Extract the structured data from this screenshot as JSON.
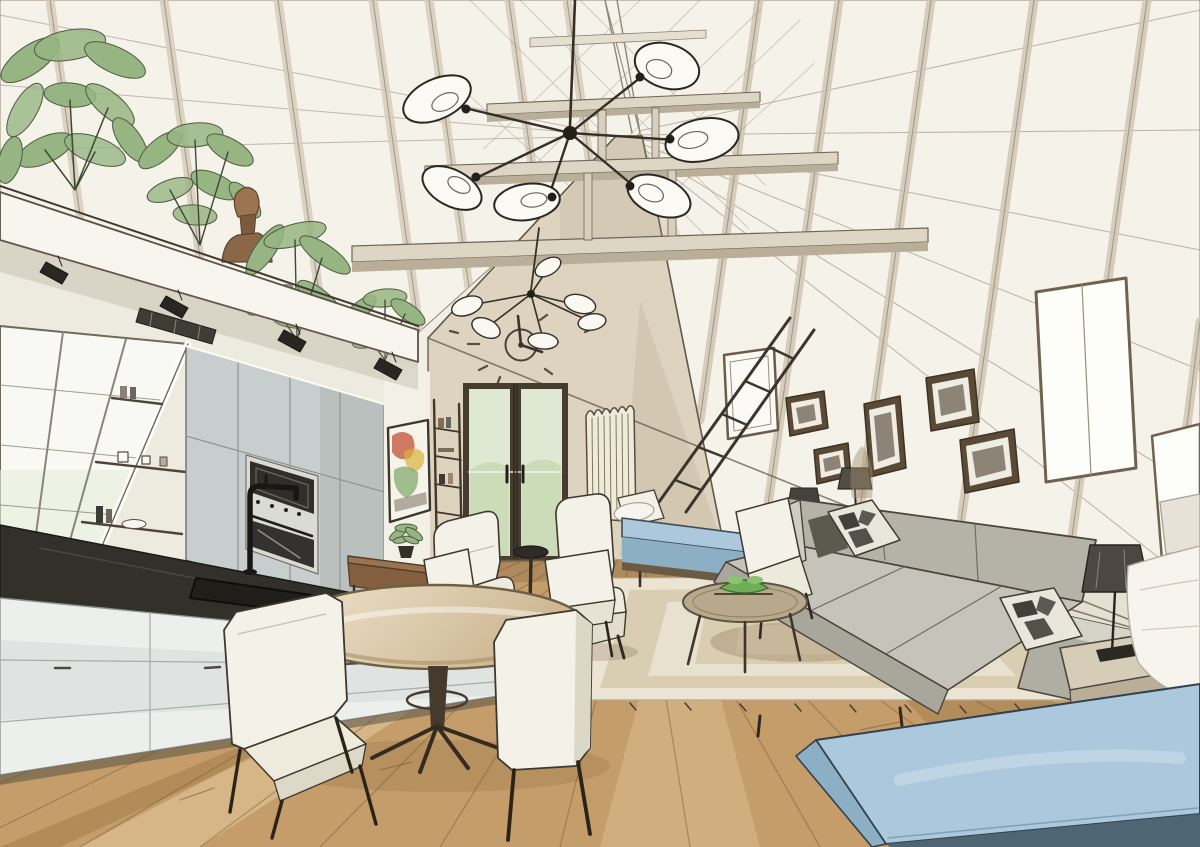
{
  "artwork": {
    "type": "ink-and-watercolor-interior-sketch",
    "subject": "A-frame attic loft living space with kitchen, dining and lounge areas",
    "objects": [
      "vaulted plank ceiling with exposed tie beams",
      "large sputnik chandelier with six glass bulbs",
      "small sputnik chandelier",
      "minimalist wall clock with scattered tick marks",
      "french doors with garden view",
      "column radiator",
      "mezzanine loft planted with greenery",
      "carved wooden bust",
      "track spotlights under loft edge",
      "sloped kitchen window with open shelves",
      "black stone counter with sink and black faucet",
      "tall gray cabinets with built-in oven and microwave",
      "abstract watercolor artwork on wall",
      "ladder bookshelf",
      "wooden console with potted plant",
      "two white armchairs with round black side table",
      "blue upholstered bench with white pillow",
      "ladder leaning on roof slope",
      "roof windows",
      "five framed pictures on roof slope",
      "gray sofa with checkered pillows",
      "table lamp on side table",
      "small floor lamp",
      "round coffee table with green bowl",
      "striped area rug with fringe",
      "round pedestal dining table",
      "white dining chairs",
      "wooden plank floor",
      "large blue daybed ottoman",
      "bed corner with white duvet"
    ],
    "palette": {
      "paper": "#f2eee6",
      "ink": "#352f27",
      "roof_plank": "#f5f2ea",
      "beam_taupe": "#ded6c4",
      "gable_wall": "#ddd3bf",
      "glass_green": "#dfe8d3",
      "plant_green": "#97b583",
      "wood_brown": "#9a7350",
      "cabinet_gray": "#c8cecd",
      "counter_dark": "#32302b",
      "floor_wood": "#c49d6b",
      "rug_light": "#ece4d2",
      "rug_band": "#d9cdb2",
      "sofa_gray": "#c6c4ba",
      "white_fabric": "#f4f1e8",
      "daybed_blue": "#abc8dc",
      "daybed_teal": "#4e6673",
      "lamp_shade": "#4c4841"
    }
  }
}
